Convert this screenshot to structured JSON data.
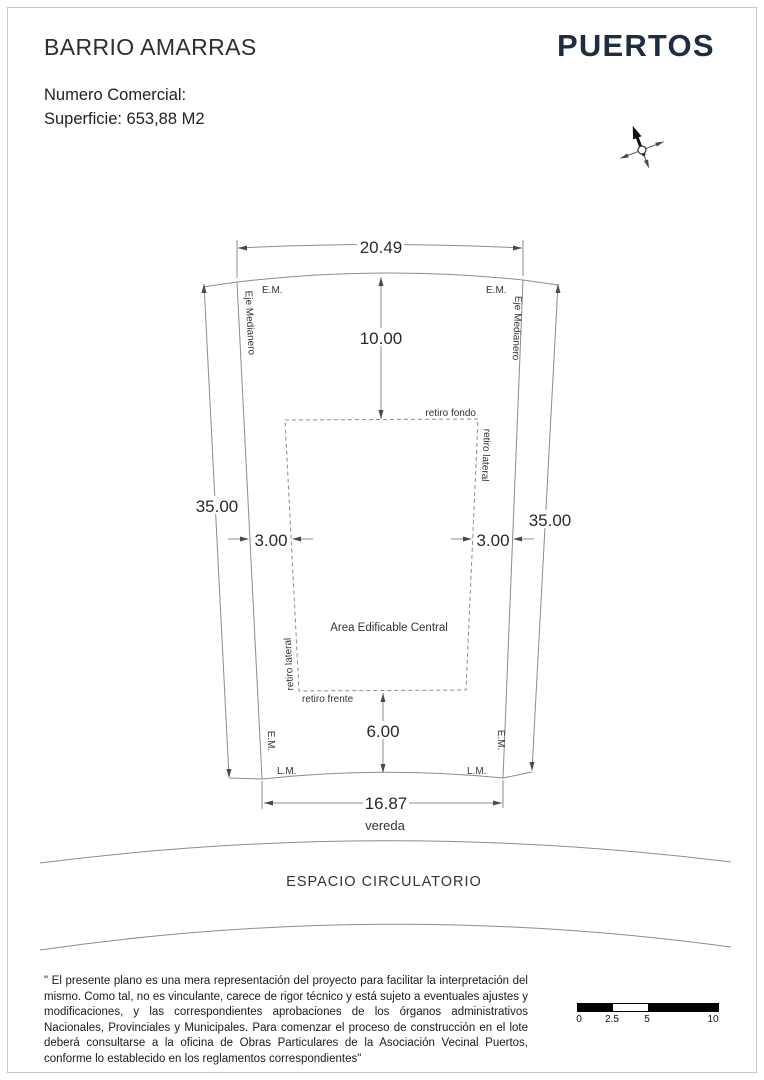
{
  "header": {
    "title": "BARRIO AMARRAS",
    "commercial_number_label": "Numero Comercial:",
    "surface_label": "Superficie: 653,88 M2"
  },
  "logo": {
    "text": "PUERTOS",
    "color": "#1e2d3f"
  },
  "plan": {
    "dimensions": {
      "top_width": "20.49",
      "rear_setback": "10.00",
      "depth_left": "35.00",
      "depth_right": "35.00",
      "side_setback_left": "3.00",
      "side_setback_right": "3.00",
      "front_setback": "6.00",
      "front_width": "16.87"
    },
    "labels": {
      "em": "E.M.",
      "lm": "L.M.",
      "eje_medianero": "Eje Medianero",
      "retiro_fondo": "retiro fondo",
      "retiro_lateral": "retiro lateral",
      "retiro_frente": "retiro frente",
      "area_edificable": "Area Edificable Central",
      "vereda": "vereda",
      "espacio_circulatorio": "ESPACIO CIRCULATORIO"
    }
  },
  "disclaimer": {
    "text": "\" El presente plano es una mera representación del proyecto para facilitar la interpretación del mismo. Como tal, no es vinculante, carece de rigor técnico y está sujeto a eventuales ajustes y modificaciones, y las correspondientes aprobaciones de los órganos administrativos Nacionales, Provinciales y Municipales. Para comenzar el proceso de construcción en el lote deberá consultarse a la oficina de Obras Particulares de la Asociación Vecinal Puertos, conforme lo establecido en los reglamentos correspondientes\""
  },
  "scale_bar": {
    "ticks": [
      "0",
      "2.5",
      "5",
      "10"
    ]
  },
  "colors": {
    "line": "#8c8c8c",
    "text": "#333333",
    "brand": "#1e2d3f",
    "background": "#ffffff"
  }
}
